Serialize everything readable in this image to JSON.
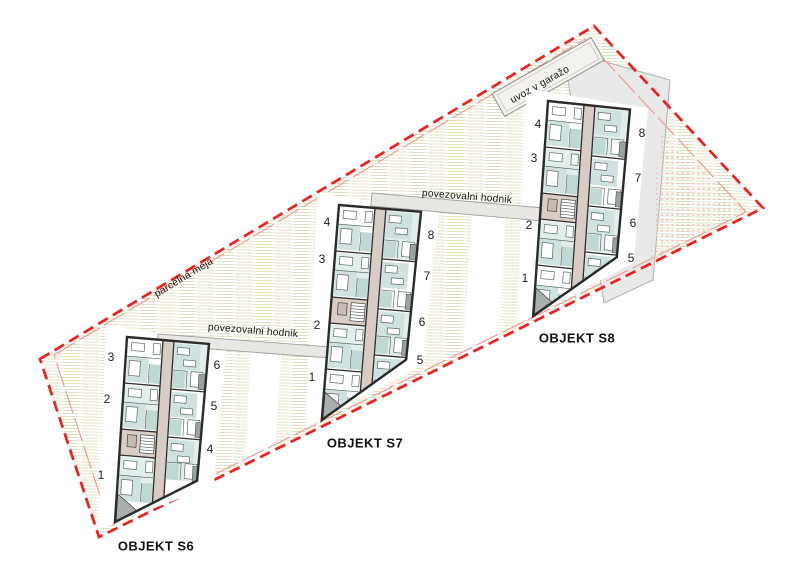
{
  "site": {
    "parcel_boundary_label": "parcelna meja",
    "garage_entry_label": "uvoz v garažo",
    "connecting_corridor_label": "povezovalni hodnik"
  },
  "labels": [
    {
      "text": "parcelna meja",
      "x": 184,
      "y": 278,
      "rot": -31
    },
    {
      "text": "uvoz v garažo",
      "x": 540,
      "y": 85,
      "rot": -29.5
    },
    {
      "text": "povezovalni hodnik",
      "x": 253,
      "y": 331,
      "rot": 4.5
    },
    {
      "text": "povezovalni hodnik",
      "x": 467,
      "y": 197,
      "rot": 4.5
    }
  ],
  "buildings": [
    {
      "name": "OBJEKT S6",
      "name_x": 156,
      "name_y": 546,
      "type": "A",
      "tf": [
        1,
        0.085,
        -0.065,
        1,
        127,
        337
      ],
      "units": [
        {
          "n": "3",
          "x": 111,
          "y": 357
        },
        {
          "n": "2",
          "x": 107,
          "y": 399
        },
        {
          "n": "1",
          "x": 101,
          "y": 475
        },
        {
          "n": "6",
          "x": 217,
          "y": 365
        },
        {
          "n": "5",
          "x": 214,
          "y": 406
        },
        {
          "n": "4",
          "x": 210,
          "y": 449
        }
      ]
    },
    {
      "name": "OBJEKT S7",
      "name_x": 365,
      "name_y": 443,
      "type": "B",
      "tf": [
        1,
        0.083,
        -0.08,
        1,
        339,
        205
      ],
      "units": [
        {
          "n": "4",
          "x": 327,
          "y": 222
        },
        {
          "n": "3",
          "x": 322,
          "y": 259
        },
        {
          "n": "2",
          "x": 317,
          "y": 325
        },
        {
          "n": "1",
          "x": 312,
          "y": 377
        },
        {
          "n": "8",
          "x": 431,
          "y": 235
        },
        {
          "n": "7",
          "x": 427,
          "y": 276
        },
        {
          "n": "6",
          "x": 422,
          "y": 322
        },
        {
          "n": "5",
          "x": 420,
          "y": 360
        }
      ]
    },
    {
      "name": "OBJEKT S8",
      "name_x": 577,
      "name_y": 338,
      "type": "B",
      "tf": [
        1,
        0.104,
        -0.069,
        1,
        548,
        101
      ],
      "units": [
        {
          "n": "4",
          "x": 538,
          "y": 124
        },
        {
          "n": "3",
          "x": 534,
          "y": 158
        },
        {
          "n": "2",
          "x": 529,
          "y": 225
        },
        {
          "n": "1",
          "x": 525,
          "y": 278
        },
        {
          "n": "8",
          "x": 642,
          "y": 133
        },
        {
          "n": "7",
          "x": 638,
          "y": 178
        },
        {
          "n": "6",
          "x": 633,
          "y": 223
        },
        {
          "n": "5",
          "x": 631,
          "y": 258
        }
      ]
    }
  ],
  "corridors": [
    {
      "x": 158,
      "y": 334,
      "len": 172,
      "h": 11,
      "rot": 4.3
    },
    {
      "x": 372,
      "y": 193,
      "len": 176,
      "h": 13,
      "rot": 5
    }
  ],
  "colors": {
    "boundary_red": "#e8231f",
    "boundary_inner_red": "#f0968f",
    "hatch_line": "#e0dfc0",
    "room_teal": "#cfe2df",
    "room_teal_dark": "#c0d8d4",
    "room_teal_light": "#e2eeec",
    "corridor_beige": "#d8ccc5",
    "entry_beige": "#dacdc5",
    "balcony_gray": "#98a3a0",
    "terrace_gray": "#a8afae",
    "garage_gray": "#e9e9e9",
    "dot_pink": "#f1c1b7",
    "wall_dark": "#2b2b2b",
    "band_fill": "#e9e7e3"
  }
}
